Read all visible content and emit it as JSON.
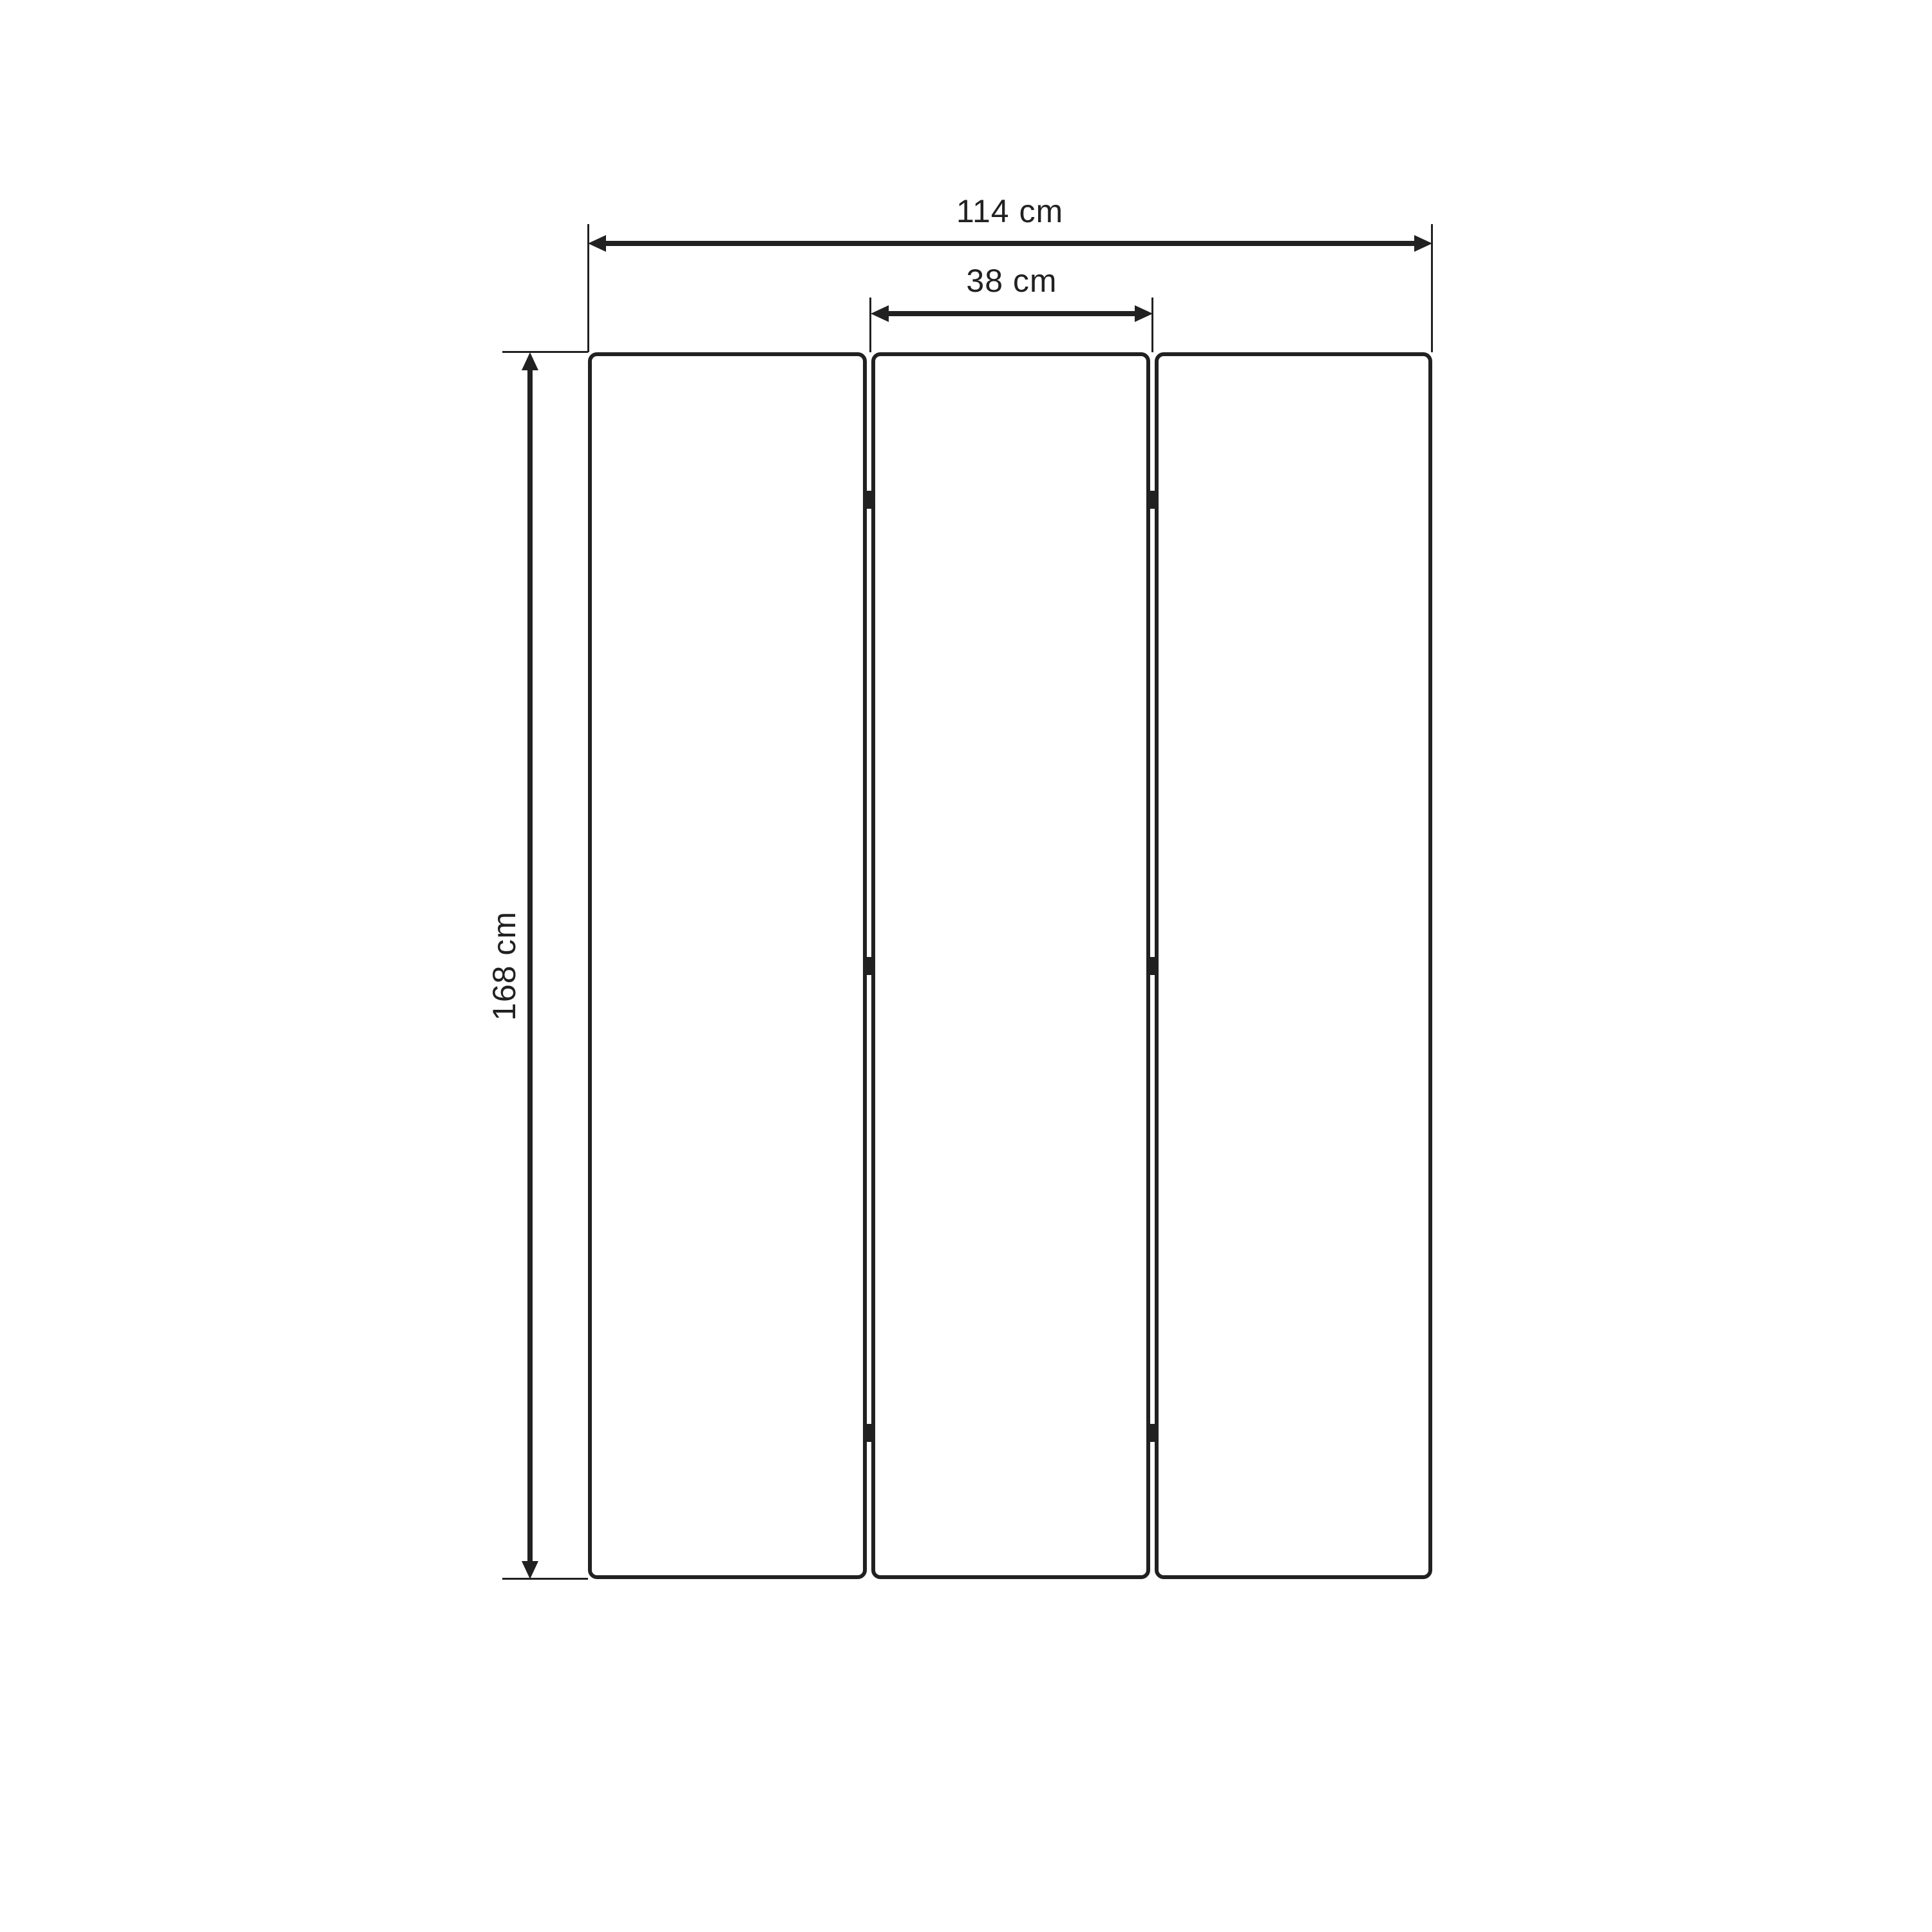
{
  "diagram": {
    "type": "furniture-dimension-drawing",
    "subject": "three-panel-folding-screen-front-view",
    "panel_count": 3,
    "hinges_per_gap": 3
  },
  "dimensions": {
    "width_total": "114 cm",
    "width_panel": "38 cm",
    "height_total": "168 cm"
  },
  "colors": {
    "background": "#ffffff",
    "line": "#212121"
  }
}
